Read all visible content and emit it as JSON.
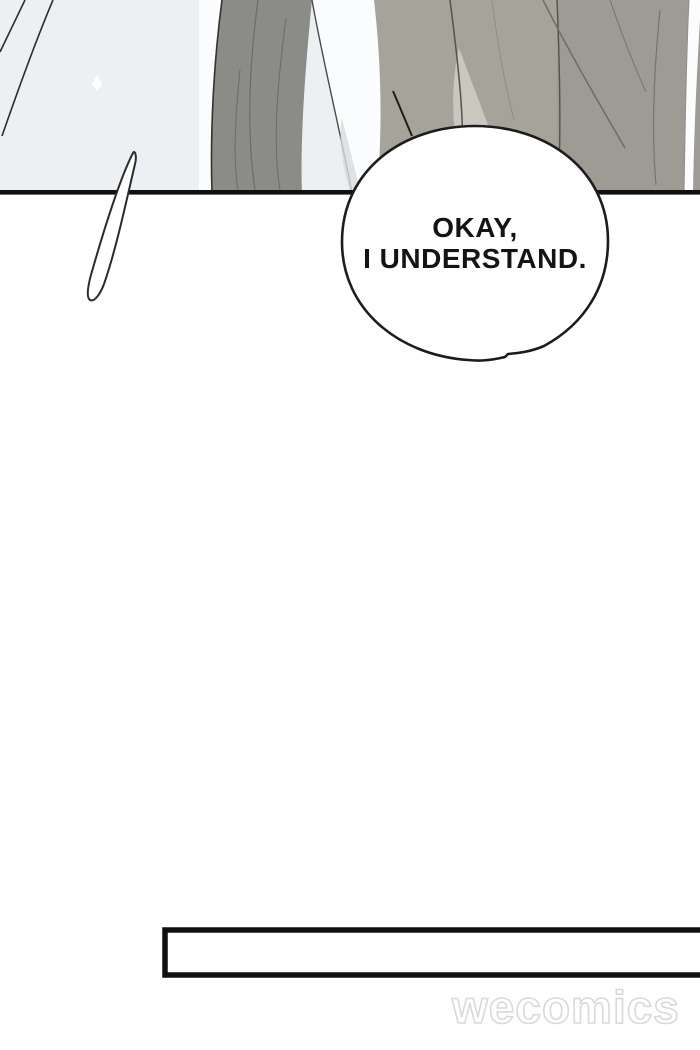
{
  "comic": {
    "bubble": {
      "line1": "OKAY,",
      "line2": "I UNDERSTAND."
    },
    "watermark": {
      "text": "wecomics"
    },
    "colors": {
      "bg_top": "#edf0f3",
      "white": "#ffffff",
      "ink": "#101010",
      "jacket_left": "#8b8b88",
      "jacket_right": "#9d9b93",
      "suit_center": "#a6a49a",
      "highlight_patch": "#c9c8be",
      "shirt": "#fbfcfd",
      "shade_soft": "#d8dbdc",
      "bubble_stroke": "#1c1c1c",
      "text_ink": "#141414",
      "watermark_stroke": "#d9d9d9"
    }
  }
}
